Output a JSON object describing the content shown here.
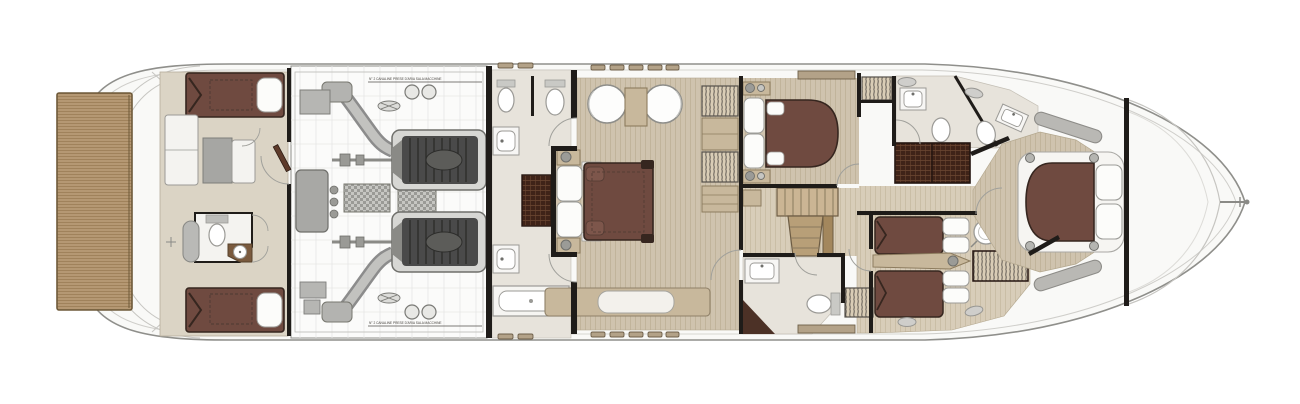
{
  "annotations": {
    "engine_note_top": "N° 2 CANALINE PRESE D'ARIA SALA MACCHINE",
    "engine_note_bottom": "N° 2 CANALINE PRESE D'ARIA SALA MACCHINE"
  },
  "palette": {
    "hull_fill": "#f9f9f7",
    "hull_line": "#8f8f8b",
    "hull_inner": "#cfceca",
    "teak": "#b59873",
    "teak_line": "#9a7d55",
    "teak_edge": "#6f5a3a",
    "wall": "#1f1c19",
    "floor_crew": "#dbd4c5",
    "floor_bath": "#e7e3db",
    "floor_wood": "#cfc3ae",
    "wood_grain": "#bcae93",
    "floor_corridor": "#d8cdb9",
    "corridor_grain": "#c4b89e",
    "bed_brown": "#6f4a40",
    "bed_brown_light": "#7d564b",
    "bed_dark": "#36261f",
    "pillow": "#fcfcfa",
    "fixture_line": "#9b9a96",
    "furn_tan": "#c8b89c",
    "furn_tan_dark": "#8d7c5f",
    "wardrobe_dark": "#3f2318",
    "wardrobe_line": "#6a4631",
    "hanger_bg": "#d9cdb6",
    "hanger_line": "#55504a",
    "engine_grey": "#a9a9a9",
    "engine_mid": "#8c8c8c",
    "engine_dark": "#4a4a4a",
    "engine_light": "#dcdcda",
    "grid_line": "#e7e7e5",
    "stair_light": "#cbb594",
    "stair_mid": "#b89f78",
    "stair_dark": "#a3875d",
    "glass_grey": "#c9c8c4",
    "win_tan": "#b3a288",
    "annotation_ink": "#44403c"
  }
}
